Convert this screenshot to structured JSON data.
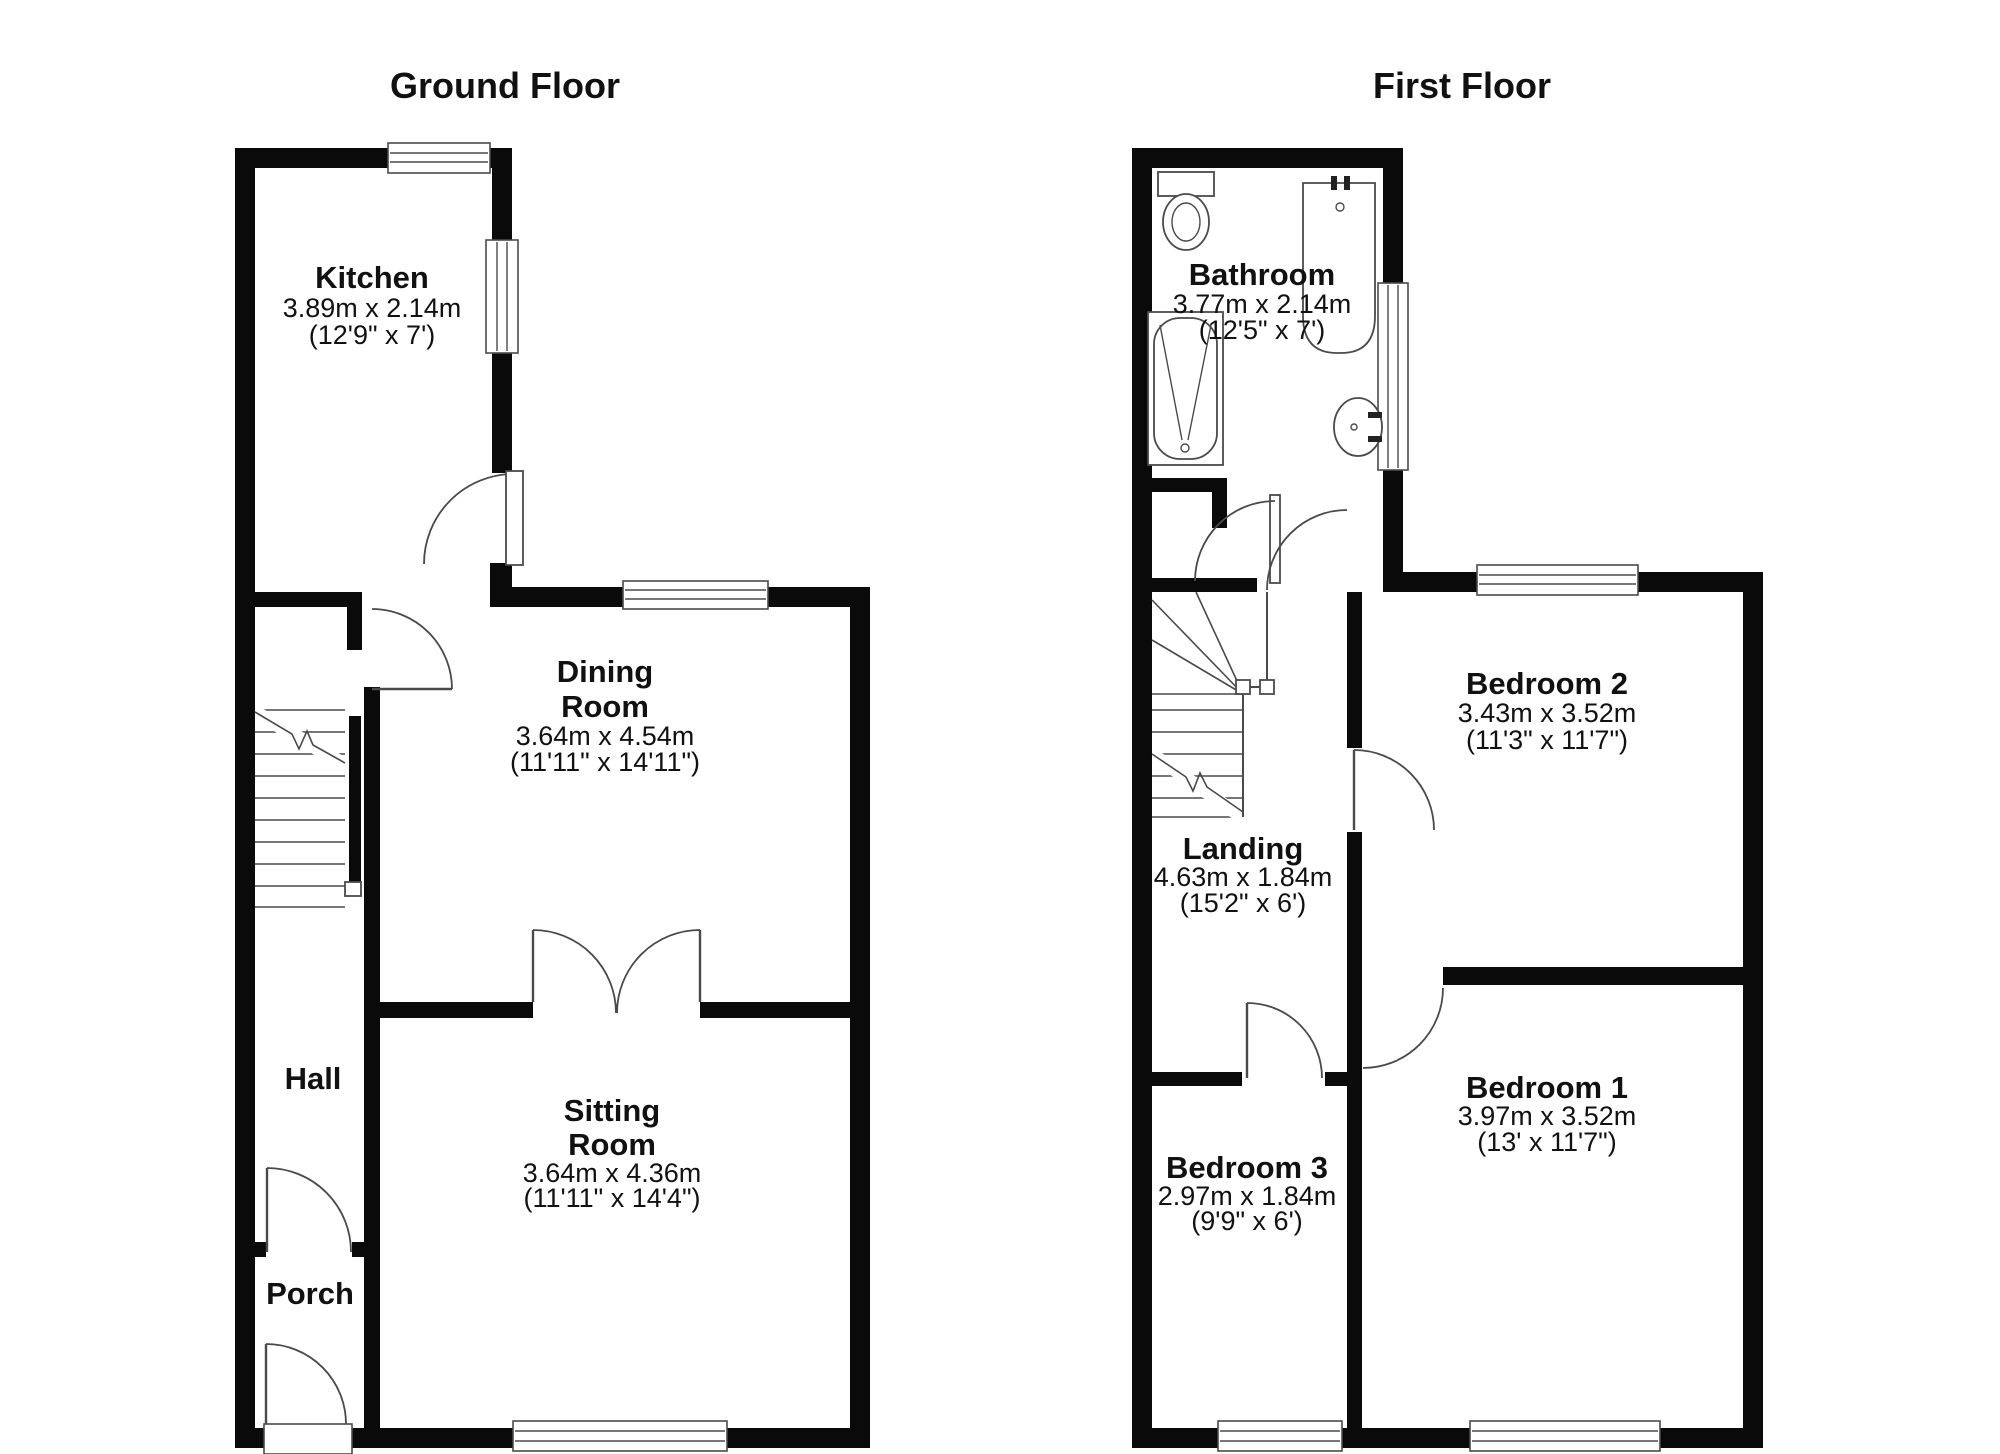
{
  "colors": {
    "background": "#ffffff",
    "wall": "#0a0a0a",
    "line": "#4a4a4a",
    "text": "#111111"
  },
  "ground_floor": {
    "title": "Ground Floor",
    "rooms": {
      "kitchen": {
        "name": "Kitchen",
        "metric": "3.89m x 2.14m",
        "imperial": "(12'9\" x 7')"
      },
      "dining": {
        "name_line1": "Dining",
        "name_line2": "Room",
        "metric": "3.64m x 4.54m",
        "imperial": "(11'11\" x 14'11\")"
      },
      "sitting": {
        "name_line1": "Sitting",
        "name_line2": "Room",
        "metric": "3.64m x 4.36m",
        "imperial": "(11'11\" x 14'4\")"
      },
      "hall": {
        "name": "Hall"
      },
      "porch": {
        "name": "Porch"
      }
    }
  },
  "first_floor": {
    "title": "First Floor",
    "rooms": {
      "bathroom": {
        "name": "Bathroom",
        "metric": "3.77m x 2.14m",
        "imperial": "(12'5\" x 7')"
      },
      "landing": {
        "name": "Landing",
        "metric": "4.63m x 1.84m",
        "imperial": "(15'2\" x 6')"
      },
      "bedroom2": {
        "name": "Bedroom 2",
        "metric": "3.43m x 3.52m",
        "imperial": "(11'3\" x 11'7\")"
      },
      "bedroom1": {
        "name": "Bedroom 1",
        "metric": "3.97m x 3.52m",
        "imperial": "(13' x 11'7\")"
      },
      "bedroom3": {
        "name": "Bedroom 3",
        "metric": "2.97m x 1.84m",
        "imperial": "(9'9\" x 6')"
      }
    }
  }
}
